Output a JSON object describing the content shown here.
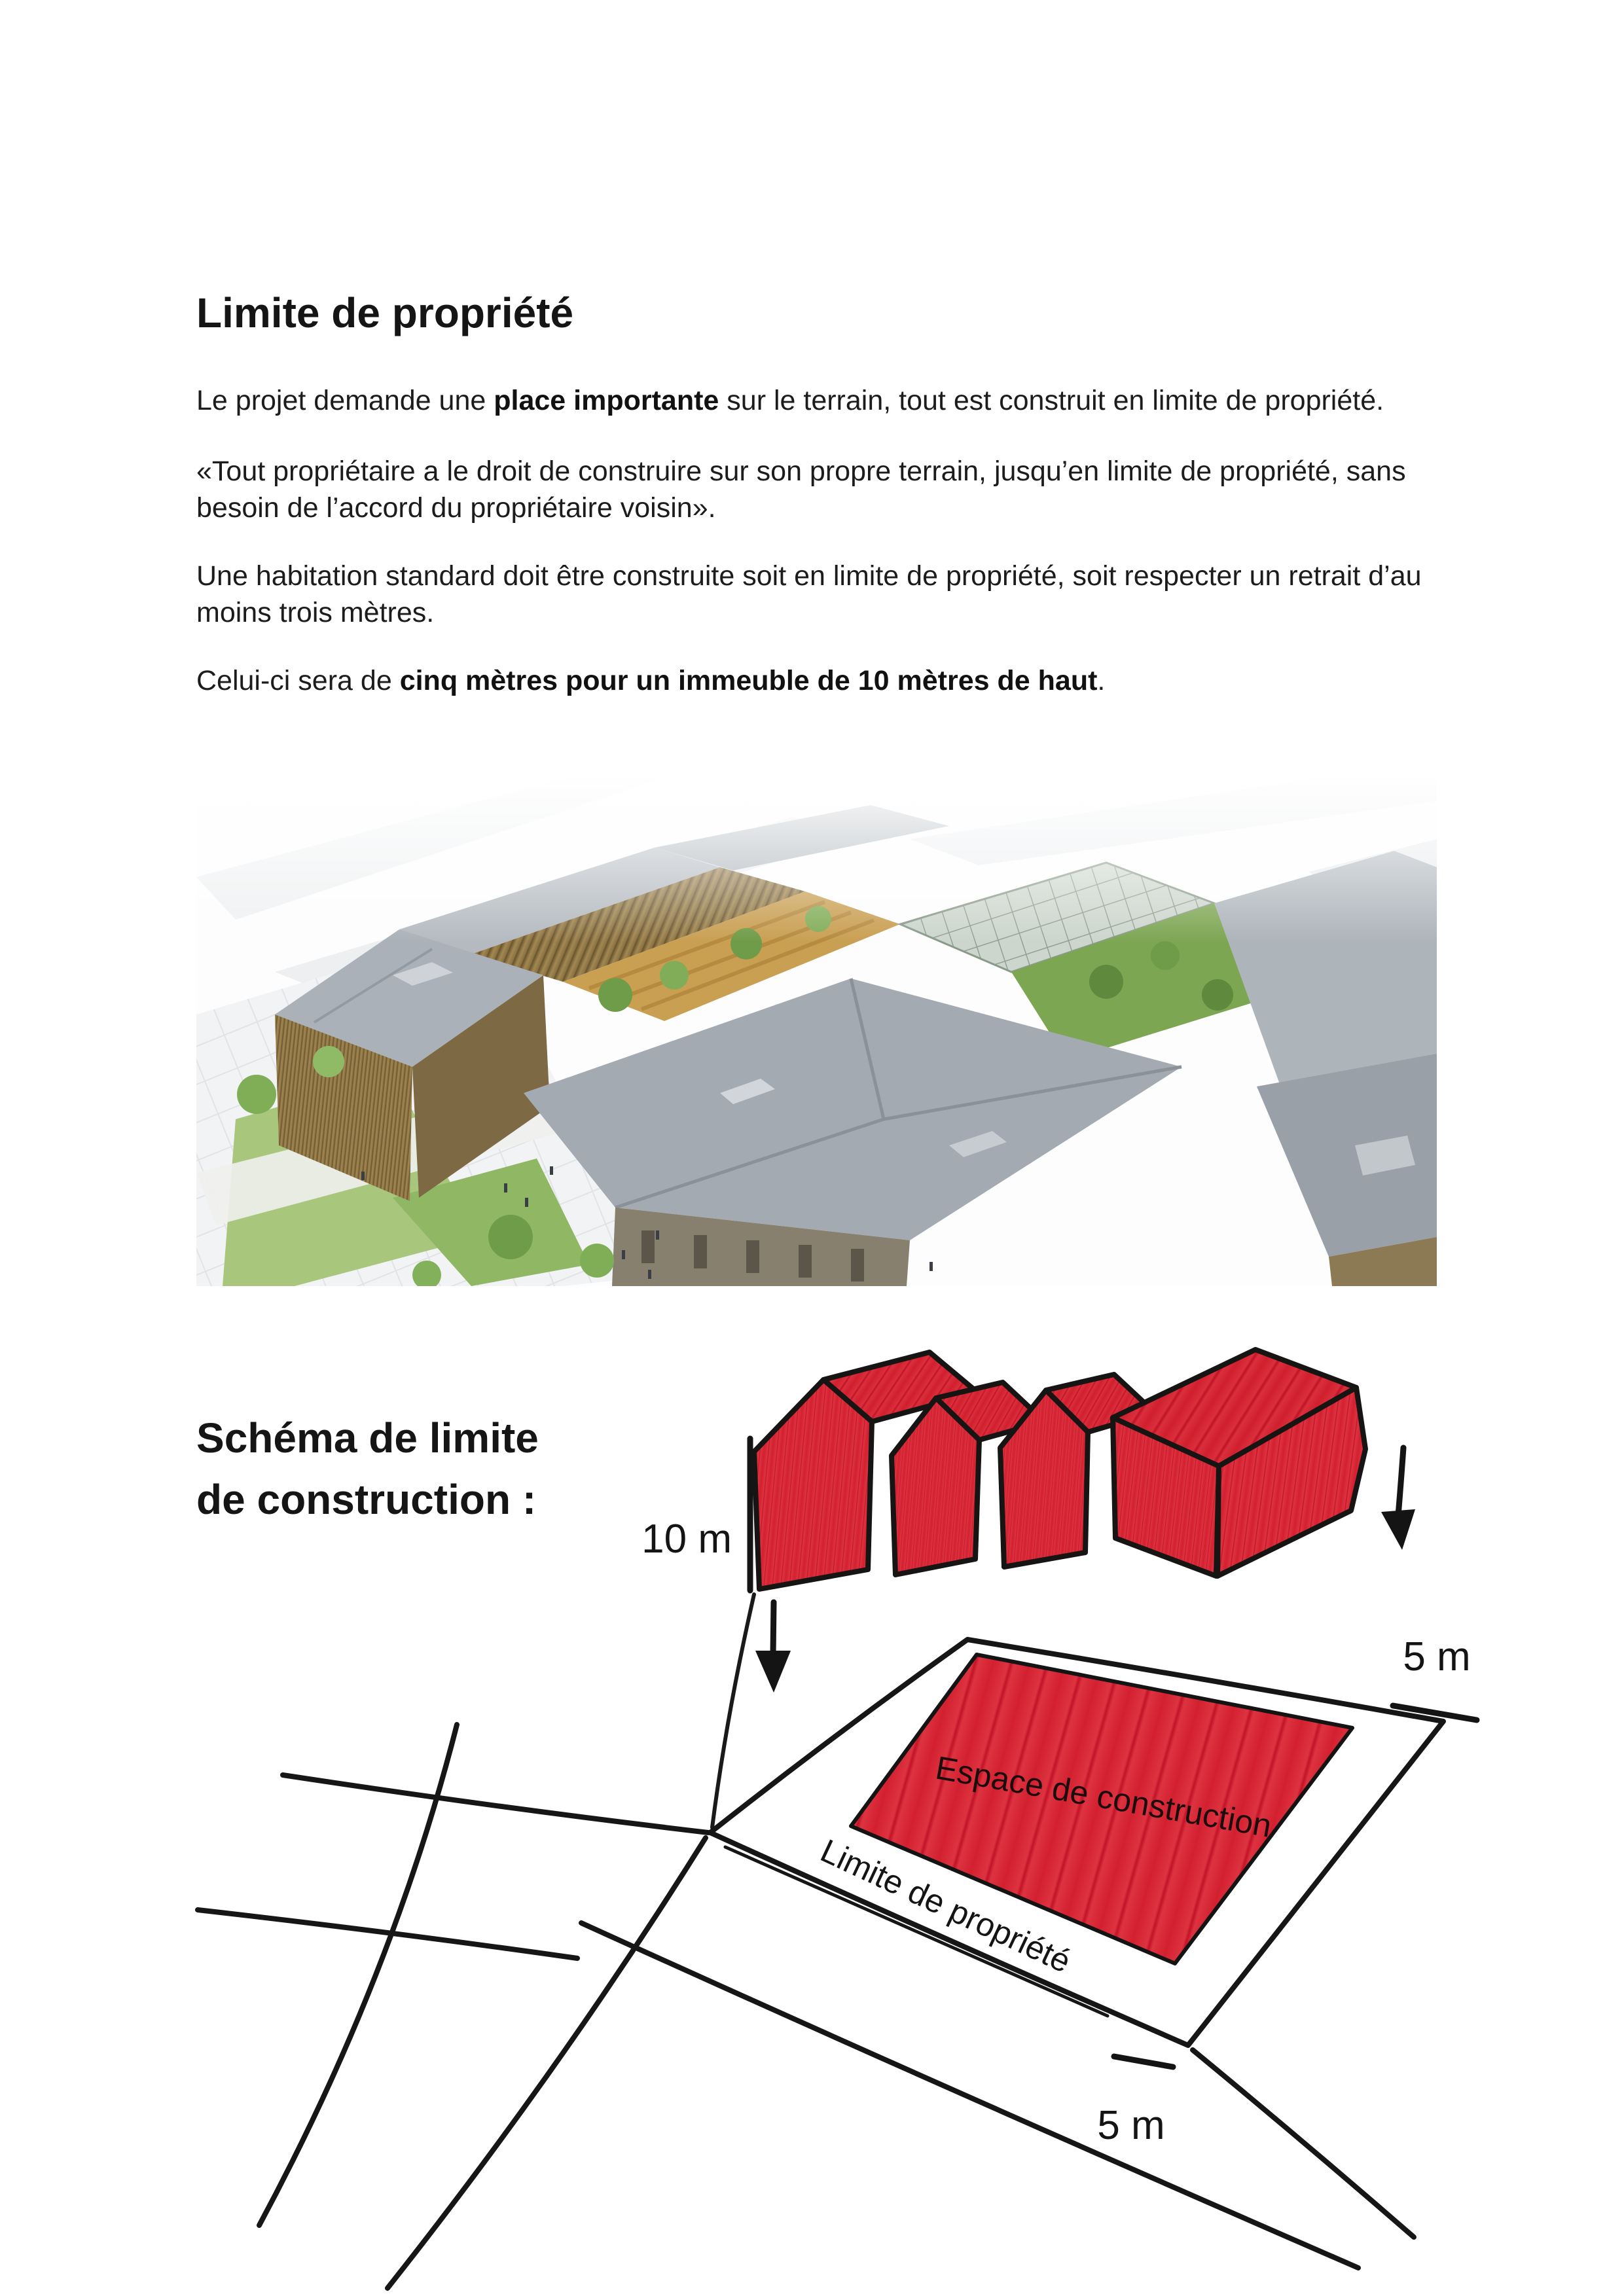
{
  "doc": {
    "title": "Limite de propriété",
    "p1": {
      "pre": "Le projet demande une ",
      "bold": "place importante",
      "post": " sur le terrain, tout est construit en limite de propriété."
    },
    "p2": "«Tout propriétaire a le droit de construire sur son propre terrain, jusqu’en limite de propriété, sans besoin de l’accord du propriétaire voisin».",
    "p3": "Une habitation standard doit être construite soit en limite de propriété, soit respecter un retrait d’au moins trois mètres.",
    "p4": {
      "pre": "Celui-ci sera de ",
      "bold": "cinq mètres pour un immeuble de 10 mètres de haut",
      "post": "."
    }
  },
  "schema": {
    "heading": "Schéma de limite\nde construction :",
    "height_label": "10 m",
    "setback_top_label": "5 m",
    "setback_bottom_label": "5 m",
    "area_label": "Espace de construction",
    "boundary_label": "Limite de propriété"
  },
  "colors": {
    "sketch_red": "#d01f2e",
    "ink": "#141414",
    "roof_gray": "#a8afb6",
    "wood_tan": "#94794a"
  }
}
